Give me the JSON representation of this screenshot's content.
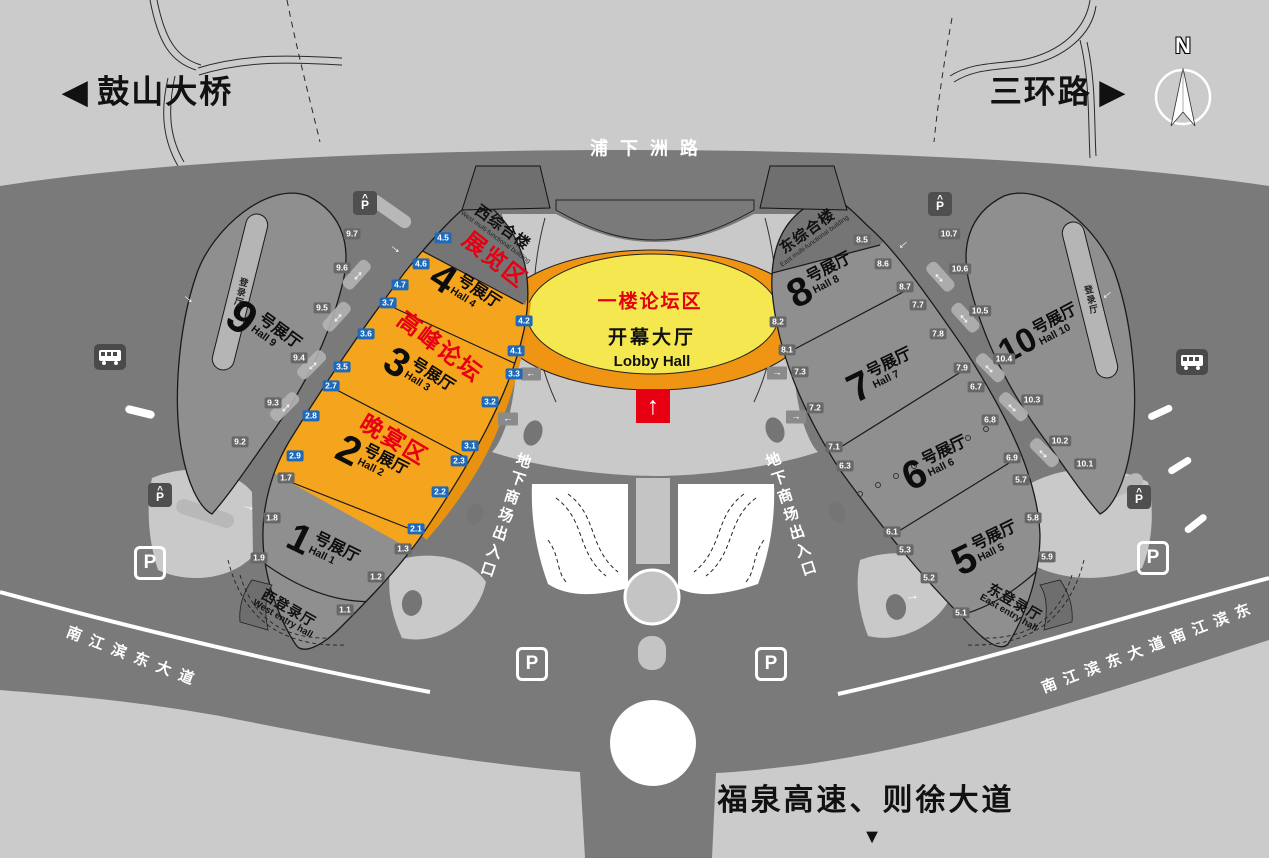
{
  "colors": {
    "road": "#7a7a7a",
    "plaza": "#c9c9c9",
    "hall_gray": "#8f8f8f",
    "cap_gray": "#757575",
    "orange": "#f5a51d",
    "walkway_orange": "#e8920f",
    "lobby_yellow": "#f4e74f",
    "accent_red": "#e60012",
    "badge_blue": "#1e6ab8",
    "badge_gray": "#676767"
  },
  "outer_roads": {
    "gushan": {
      "dir": "◀",
      "label": "鼓山大桥"
    },
    "sanhuan": {
      "label": "三环路",
      "dir": "▶"
    },
    "puxiazhou": {
      "label": "浦下洲路"
    },
    "fuquan": {
      "label": "福泉高速、则徐大道",
      "dir": "▼"
    },
    "avenue_west": {
      "label": "南江滨东大道"
    },
    "avenue_east": {
      "label": "南江滨东大道南江滨东"
    }
  },
  "compass": {
    "label": "N"
  },
  "lobby": {
    "zone": "一楼论坛区",
    "name": "开幕大厅",
    "name_en": "Lobby Hall"
  },
  "underground": {
    "west": "地下商场出入口",
    "east": "地下商场出入口"
  },
  "west_complex": {
    "building": {
      "name": "西综合楼",
      "name_en": "West multi-functional building"
    },
    "zones": [
      "展览区",
      "高峰论坛",
      "晚宴区"
    ],
    "halls": [
      {
        "num": "4",
        "suffix": "号展厅",
        "en": "Hall 4"
      },
      {
        "num": "3",
        "suffix": "号展厅",
        "en": "Hall 3"
      },
      {
        "num": "2",
        "suffix": "号展厅",
        "en": "Hall 2"
      },
      {
        "num": "1",
        "suffix": "号展厅",
        "en": "Hall 1"
      },
      {
        "num": "9",
        "suffix": "号展厅",
        "en": "Hall 9"
      }
    ],
    "entry": {
      "name": "西登录厅",
      "name_en": "West entry hall"
    },
    "strip": "登录厅"
  },
  "east_complex": {
    "building": {
      "name": "东综合楼",
      "name_en": "East multi-functional building"
    },
    "halls": [
      {
        "num": "8",
        "suffix": "号展厅",
        "en": "Hall 8"
      },
      {
        "num": "7",
        "suffix": "号展厅",
        "en": "Hall 7"
      },
      {
        "num": "6",
        "suffix": "号展厅",
        "en": "Hall 6"
      },
      {
        "num": "5",
        "suffix": "号展厅",
        "en": "Hall 5"
      },
      {
        "num": "10",
        "suffix": "号展厅",
        "en": "Hall 10"
      }
    ],
    "entry": {
      "name": "东登录厅",
      "name_en": "East entry hall"
    },
    "strip": "登录厅"
  },
  "parking": {
    "label": "P"
  },
  "icons": {
    "up_arrow": "↑",
    "double_arrow": "↔",
    "arrow": "→",
    "left_arrow": "←",
    "right_arrow": "→"
  },
  "gates": [
    {
      "label": "4.5",
      "x": 443,
      "y": 238,
      "kind": "blue"
    },
    {
      "label": "4.6",
      "x": 421,
      "y": 264,
      "kind": "blue"
    },
    {
      "label": "4.7",
      "x": 400,
      "y": 285,
      "kind": "blue"
    },
    {
      "label": "3.7",
      "x": 388,
      "y": 303,
      "kind": "blue"
    },
    {
      "label": "3.6",
      "x": 366,
      "y": 334,
      "kind": "blue"
    },
    {
      "label": "3.5",
      "x": 342,
      "y": 367,
      "kind": "blue"
    },
    {
      "label": "2.7",
      "x": 331,
      "y": 386,
      "kind": "blue"
    },
    {
      "label": "2.8",
      "x": 311,
      "y": 416,
      "kind": "blue"
    },
    {
      "label": "2.9",
      "x": 295,
      "y": 456,
      "kind": "blue"
    },
    {
      "label": "4.2",
      "x": 524,
      "y": 321,
      "kind": "blue"
    },
    {
      "label": "4.1",
      "x": 516,
      "y": 351,
      "kind": "blue"
    },
    {
      "label": "3.3",
      "x": 514,
      "y": 374,
      "kind": "blue"
    },
    {
      "label": "3.2",
      "x": 490,
      "y": 402,
      "kind": "blue"
    },
    {
      "label": "3.1",
      "x": 470,
      "y": 446,
      "kind": "blue"
    },
    {
      "label": "2.3",
      "x": 459,
      "y": 461,
      "kind": "blue"
    },
    {
      "label": "2.2",
      "x": 440,
      "y": 492,
      "kind": "blue"
    },
    {
      "label": "2.1",
      "x": 416,
      "y": 529,
      "kind": "blue"
    },
    {
      "label": "9.7",
      "x": 352,
      "y": 234,
      "kind": "gray"
    },
    {
      "label": "9.6",
      "x": 342,
      "y": 268,
      "kind": "gray"
    },
    {
      "label": "9.5",
      "x": 322,
      "y": 308,
      "kind": "gray"
    },
    {
      "label": "9.4",
      "x": 299,
      "y": 358,
      "kind": "gray"
    },
    {
      "label": "9.3",
      "x": 273,
      "y": 403,
      "kind": "gray"
    },
    {
      "label": "9.2",
      "x": 240,
      "y": 442,
      "kind": "gray"
    },
    {
      "label": "1.7",
      "x": 286,
      "y": 478,
      "kind": "gray"
    },
    {
      "label": "1.8",
      "x": 272,
      "y": 518,
      "kind": "gray"
    },
    {
      "label": "1.9",
      "x": 259,
      "y": 558,
      "kind": "gray"
    },
    {
      "label": "1.3",
      "x": 403,
      "y": 549,
      "kind": "gray"
    },
    {
      "label": "1.2",
      "x": 376,
      "y": 577,
      "kind": "gray"
    },
    {
      "label": "1.1",
      "x": 345,
      "y": 610,
      "kind": "gray"
    },
    {
      "label": "8.5",
      "x": 862,
      "y": 240,
      "kind": "gray"
    },
    {
      "label": "8.6",
      "x": 883,
      "y": 264,
      "kind": "gray"
    },
    {
      "label": "8.7",
      "x": 905,
      "y": 287,
      "kind": "gray"
    },
    {
      "label": "7.7",
      "x": 918,
      "y": 305,
      "kind": "gray"
    },
    {
      "label": "7.8",
      "x": 938,
      "y": 334,
      "kind": "gray"
    },
    {
      "label": "7.9",
      "x": 962,
      "y": 368,
      "kind": "gray"
    },
    {
      "label": "6.7",
      "x": 976,
      "y": 387,
      "kind": "gray"
    },
    {
      "label": "6.8",
      "x": 990,
      "y": 420,
      "kind": "gray"
    },
    {
      "label": "6.9",
      "x": 1012,
      "y": 458,
      "kind": "gray"
    },
    {
      "label": "5.7",
      "x": 1021,
      "y": 480,
      "kind": "gray"
    },
    {
      "label": "5.8",
      "x": 1033,
      "y": 518,
      "kind": "gray"
    },
    {
      "label": "5.9",
      "x": 1047,
      "y": 557,
      "kind": "gray"
    },
    {
      "label": "8.2",
      "x": 778,
      "y": 322,
      "kind": "gray"
    },
    {
      "label": "8.1",
      "x": 787,
      "y": 350,
      "kind": "gray"
    },
    {
      "label": "7.3",
      "x": 800,
      "y": 372,
      "kind": "gray"
    },
    {
      "label": "7.2",
      "x": 815,
      "y": 408,
      "kind": "gray"
    },
    {
      "label": "7.1",
      "x": 834,
      "y": 447,
      "kind": "gray"
    },
    {
      "label": "6.3",
      "x": 845,
      "y": 466,
      "kind": "gray"
    },
    {
      "label": "6.1",
      "x": 892,
      "y": 532,
      "kind": "gray"
    },
    {
      "label": "5.3",
      "x": 905,
      "y": 550,
      "kind": "gray"
    },
    {
      "label": "5.2",
      "x": 929,
      "y": 578,
      "kind": "gray"
    },
    {
      "label": "5.1",
      "x": 961,
      "y": 613,
      "kind": "gray"
    },
    {
      "label": "10.7",
      "x": 949,
      "y": 234,
      "kind": "gray"
    },
    {
      "label": "10.6",
      "x": 960,
      "y": 269,
      "kind": "gray"
    },
    {
      "label": "10.5",
      "x": 980,
      "y": 311,
      "kind": "gray"
    },
    {
      "label": "10.4",
      "x": 1004,
      "y": 359,
      "kind": "gray"
    },
    {
      "label": "10.3",
      "x": 1032,
      "y": 400,
      "kind": "gray"
    },
    {
      "label": "10.2",
      "x": 1060,
      "y": 441,
      "kind": "gray"
    },
    {
      "label": "10.1",
      "x": 1085,
      "y": 464,
      "kind": "gray"
    }
  ]
}
